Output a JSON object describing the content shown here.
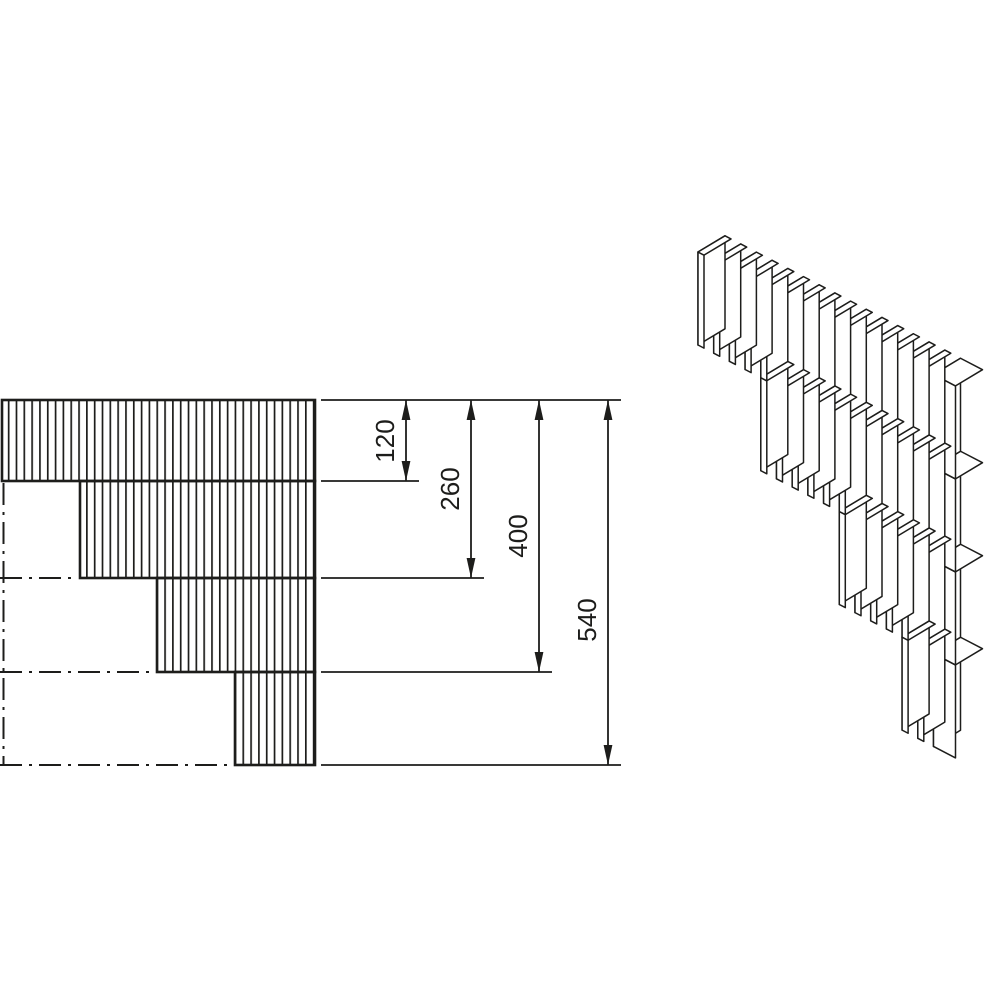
{
  "drawing": {
    "type": "technical-detail-stepped-lamella-wall-corner",
    "background": "#ffffff",
    "line_color": "#1d1d1b"
  },
  "dimensions": [
    {
      "label": "120",
      "value": 120
    },
    {
      "label": "260",
      "value": 260
    },
    {
      "label": "400",
      "value": 400
    },
    {
      "label": "540",
      "value": 540
    }
  ],
  "views": {
    "elevation": {
      "courses": 4,
      "course_bottom_dims_from_top": [
        120,
        260,
        400,
        540
      ],
      "hatch": "vertical-lines",
      "centerline_style": "dash-dot"
    },
    "isometric": {
      "courses": 4,
      "slat_count": 15,
      "course_start_slat": [
        0,
        4,
        9,
        13
      ],
      "has_end_block": true
    }
  }
}
